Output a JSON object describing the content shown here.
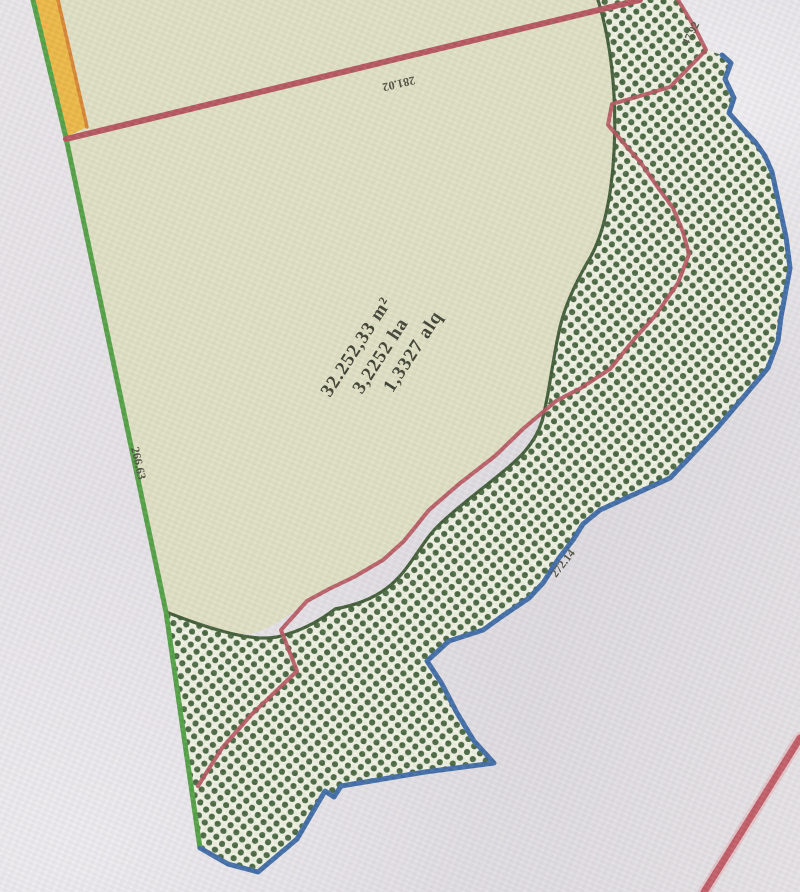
{
  "map": {
    "parcel": {
      "area_label": {
        "line1": "32.252,33 m²",
        "line2": "3,2252 ha",
        "line3": "1,3327 alq"
      }
    },
    "measurements": {
      "top_edge": "281.02",
      "left_edge": "266.63",
      "blue_edge": "272.14",
      "top_right_edge": "47.92"
    },
    "legend_semantics": {
      "hatch_area": "cross-hatched vegetation area",
      "parcel_area": "surveyed parcel"
    }
  },
  "colors": {
    "paper": "#e4e1e6",
    "parcel_fill": "#dfe0c3",
    "hatch_bg": "#eef1e1",
    "hatch_dot": "#47663e",
    "outline_dark_green": "#3f5c36",
    "boundary_green": "#51a043",
    "boundary_yellow": "#ecb843",
    "boundary_orange": "#d8832f",
    "boundary_red": "#b5535c",
    "boundary_blue": "#3e6ba6",
    "road_red": "#c05a64",
    "road_red_halo": "#e2aeb2",
    "text_dark": "#3b3e2f"
  }
}
